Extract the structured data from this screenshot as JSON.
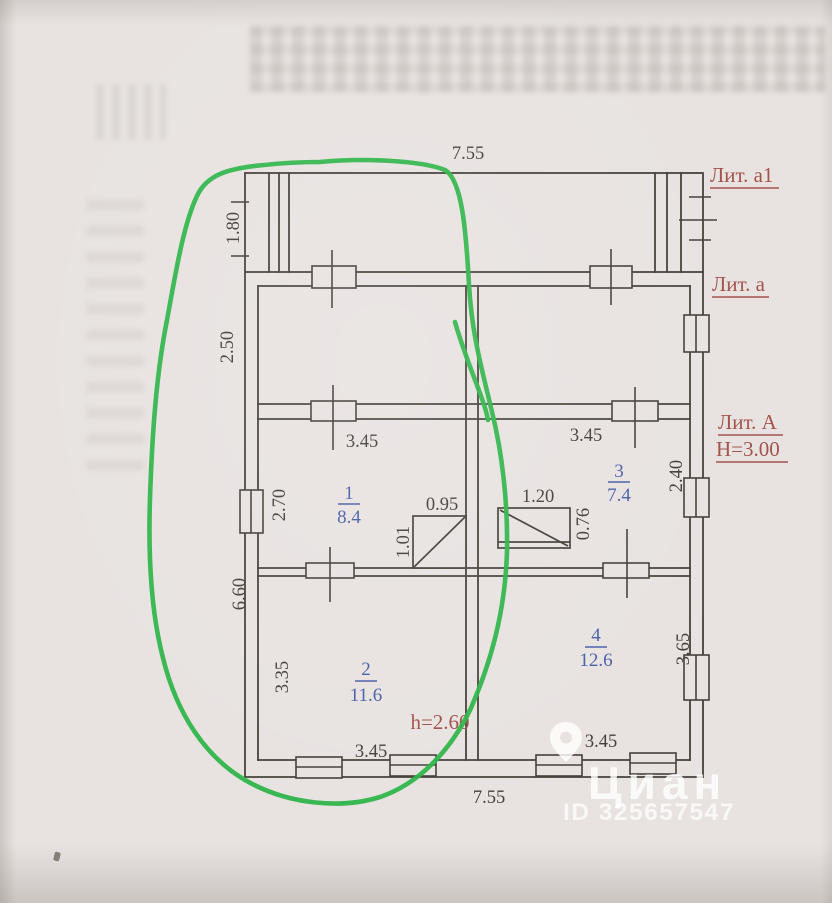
{
  "document": {
    "type": "scanned floor plan",
    "overall_width_top": "7.55",
    "overall_width_bottom": "7.55"
  },
  "labels": {
    "veranda": "Лит. а1",
    "annex": "Лит. а",
    "main": "Лит. А",
    "main_height": "Н=3.00",
    "room2_height": "h=2.60"
  },
  "left_dimensions": {
    "veranda_depth": "1.80",
    "annex_depth": "2.50",
    "main_depth": "6.60"
  },
  "rooms": [
    {
      "number": "1",
      "area": "8.4",
      "width": "3.45",
      "depth": "2.70"
    },
    {
      "number": "2",
      "area": "11.6",
      "width": "3.45",
      "depth": "3.35"
    },
    {
      "number": "3",
      "area": "7.4",
      "width": "3.45",
      "depth": "2.40"
    },
    {
      "number": "4",
      "area": "12.6",
      "width": "3.45",
      "depth": "3.65"
    }
  ],
  "stoves": [
    {
      "width": "0.95",
      "depth": "1.01"
    },
    {
      "width": "1.20",
      "depth": "0.76"
    }
  ],
  "watermark": {
    "brand": "Циан",
    "id": "ID 325657547"
  },
  "colors": {
    "paper": "#e8e3e1",
    "line": "#45403a",
    "red_label": "#a3524c",
    "blue_number": "#4a5fa8",
    "green_annotation": "#2eb449"
  }
}
